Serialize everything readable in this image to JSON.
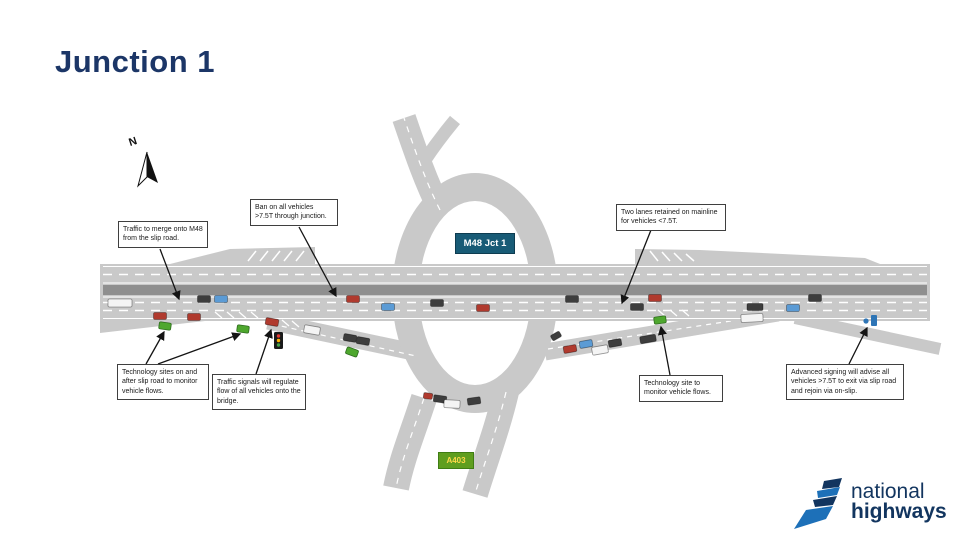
{
  "page": {
    "title": "Junction 1"
  },
  "compass": {
    "label": "N"
  },
  "junction_badge": {
    "label": "M48 Jct 1",
    "bg": "#185b76",
    "text_color": "#ffffff"
  },
  "a_road_badge": {
    "label": "A403",
    "bg": "#5f9e1f",
    "text_color": "#ffd94a"
  },
  "callouts": [
    {
      "id": "merge",
      "text": "Traffic to merge onto M48 from the slip road."
    },
    {
      "id": "ban",
      "text": "Ban on all vehicles >7.5T through junction."
    },
    {
      "id": "two-lanes",
      "text": "Two lanes retained on mainline for vehicles <7.5T."
    },
    {
      "id": "tech-sites",
      "text": "Technology sites on and after slip road to monitor vehicle flows."
    },
    {
      "id": "signals",
      "text": "Traffic signals will regulate flow of all vehicles onto the bridge."
    },
    {
      "id": "tech-site",
      "text": "Technology site to monitor vehicle flows."
    },
    {
      "id": "advance",
      "text": "Advanced signing will advise all vehicles >7.5T to exit via slip road and rejoin via on-slip."
    }
  ],
  "logo": {
    "line1": "national",
    "line2": "highways"
  },
  "colors": {
    "title": "#1c3667",
    "road": "#c9c9c9",
    "median": "#8f8f8f",
    "marking": "#ffffff",
    "sensor": "#4ea72e",
    "sensor_border": "#2e6b1e",
    "signal_red": "#e53935",
    "signal_amber": "#ffb300",
    "signal_green": "#43a047",
    "sign_blue": "#2e75b6",
    "logo_blue": "#1d70b8",
    "logo_navy": "#12355f",
    "vehicles": {
      "red": "#b03a2e",
      "blue": "#5b9bd5",
      "dark": "#3d3d3d",
      "white": "#f4f4f4"
    }
  },
  "diagram": {
    "vehicles": [
      {
        "x": 120,
        "y": 303,
        "w": 24,
        "h": 8,
        "a": 0,
        "type": "white"
      },
      {
        "x": 160,
        "y": 316,
        "a": 0,
        "type": "red"
      },
      {
        "x": 194,
        "y": 317,
        "a": 0,
        "type": "red"
      },
      {
        "x": 204,
        "y": 299,
        "a": 0,
        "type": "dark"
      },
      {
        "x": 221,
        "y": 299,
        "a": 0,
        "type": "blue"
      },
      {
        "x": 353,
        "y": 299,
        "a": 0,
        "type": "red"
      },
      {
        "x": 388,
        "y": 307,
        "a": 0,
        "type": "blue"
      },
      {
        "x": 437,
        "y": 303,
        "a": 0,
        "type": "dark"
      },
      {
        "x": 483,
        "y": 308,
        "a": 0,
        "type": "red"
      },
      {
        "x": 572,
        "y": 299,
        "a": 0,
        "type": "dark"
      },
      {
        "x": 637,
        "y": 307,
        "a": 0,
        "type": "dark"
      },
      {
        "x": 655,
        "y": 298,
        "a": 0,
        "type": "red"
      },
      {
        "x": 755,
        "y": 307,
        "w": 16,
        "a": 0,
        "type": "dark"
      },
      {
        "x": 793,
        "y": 308,
        "a": 0,
        "type": "blue"
      },
      {
        "x": 815,
        "y": 298,
        "a": 0,
        "type": "dark"
      },
      {
        "x": 752,
        "y": 318,
        "w": 22,
        "h": 8,
        "a": -3,
        "type": "white"
      },
      {
        "x": 272,
        "y": 322,
        "a": 10,
        "type": "red"
      },
      {
        "x": 312,
        "y": 330,
        "w": 16,
        "h": 8,
        "a": 10,
        "type": "white"
      },
      {
        "x": 350,
        "y": 338,
        "a": 10,
        "type": "dark"
      },
      {
        "x": 363,
        "y": 341,
        "a": 10,
        "type": "dark"
      },
      {
        "x": 428,
        "y": 396,
        "w": 9,
        "h": 6,
        "a": 8,
        "type": "red"
      },
      {
        "x": 440,
        "y": 399,
        "a": 8,
        "type": "dark"
      },
      {
        "x": 452,
        "y": 404,
        "w": 16,
        "h": 8,
        "a": 3,
        "type": "white"
      },
      {
        "x": 474,
        "y": 401,
        "a": -8,
        "type": "dark"
      },
      {
        "x": 556,
        "y": 336,
        "w": 10,
        "h": 6,
        "a": -30,
        "type": "dark"
      },
      {
        "x": 570,
        "y": 349,
        "a": -10,
        "type": "red"
      },
      {
        "x": 586,
        "y": 344,
        "a": -10,
        "type": "blue"
      },
      {
        "x": 600,
        "y": 350,
        "w": 16,
        "h": 8,
        "a": -10,
        "type": "white"
      },
      {
        "x": 615,
        "y": 343,
        "a": -10,
        "type": "dark"
      },
      {
        "x": 648,
        "y": 339,
        "w": 16,
        "a": -10,
        "type": "dark"
      }
    ],
    "sensors": [
      {
        "x": 165,
        "y": 326,
        "a": 8
      },
      {
        "x": 243,
        "y": 329,
        "a": 8
      },
      {
        "x": 352,
        "y": 352,
        "a": 20
      },
      {
        "x": 660,
        "y": 320,
        "a": -8
      }
    ]
  }
}
